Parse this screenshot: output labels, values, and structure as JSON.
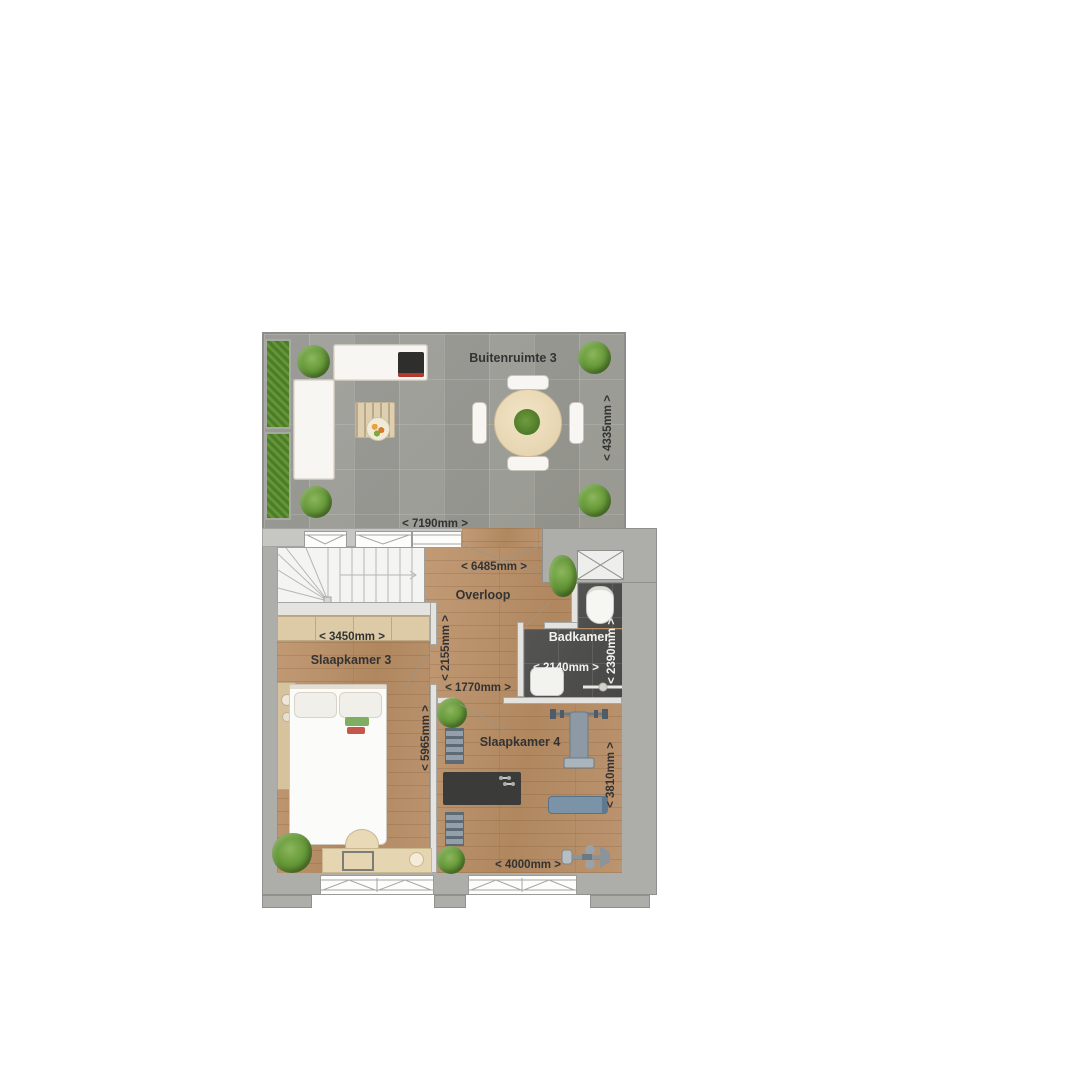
{
  "floorplan": {
    "rooms": {
      "buitenruimte": "Buitenruimte 3",
      "overloop": "Overloop",
      "badkamer": "Badkamer",
      "slaapkamer3": "Slaapkamer 3",
      "slaapkamer4": "Slaapkamer 4"
    },
    "dimensions": {
      "buitenruimte_width": "< 7190mm >",
      "buitenruimte_depth": "< 4335mm >",
      "overloop_width": "< 6485mm >",
      "overloop_depth": "< 2155mm >",
      "overloop_passage": "< 1770mm >",
      "badkamer_width": "< 2140mm >",
      "badkamer_depth": "< 2390mm >",
      "slaapkamer3_width": "< 3450mm >",
      "slaapkamer3_depth": "< 5965mm >",
      "slaapkamer4_width": "< 4000mm >",
      "slaapkamer4_depth": "< 3810mm >"
    },
    "colors": {
      "terrace_tile": "#9b9b97",
      "wood_floor": "#b78f6b",
      "bathroom_tile": "#4e4e4c",
      "outer_wall": "#adadaa",
      "partition_wall": "#e4e3df",
      "hedge_green": "#55832e",
      "label_text": "#333333",
      "label_text_on_dark": "#f1f1ee"
    }
  }
}
